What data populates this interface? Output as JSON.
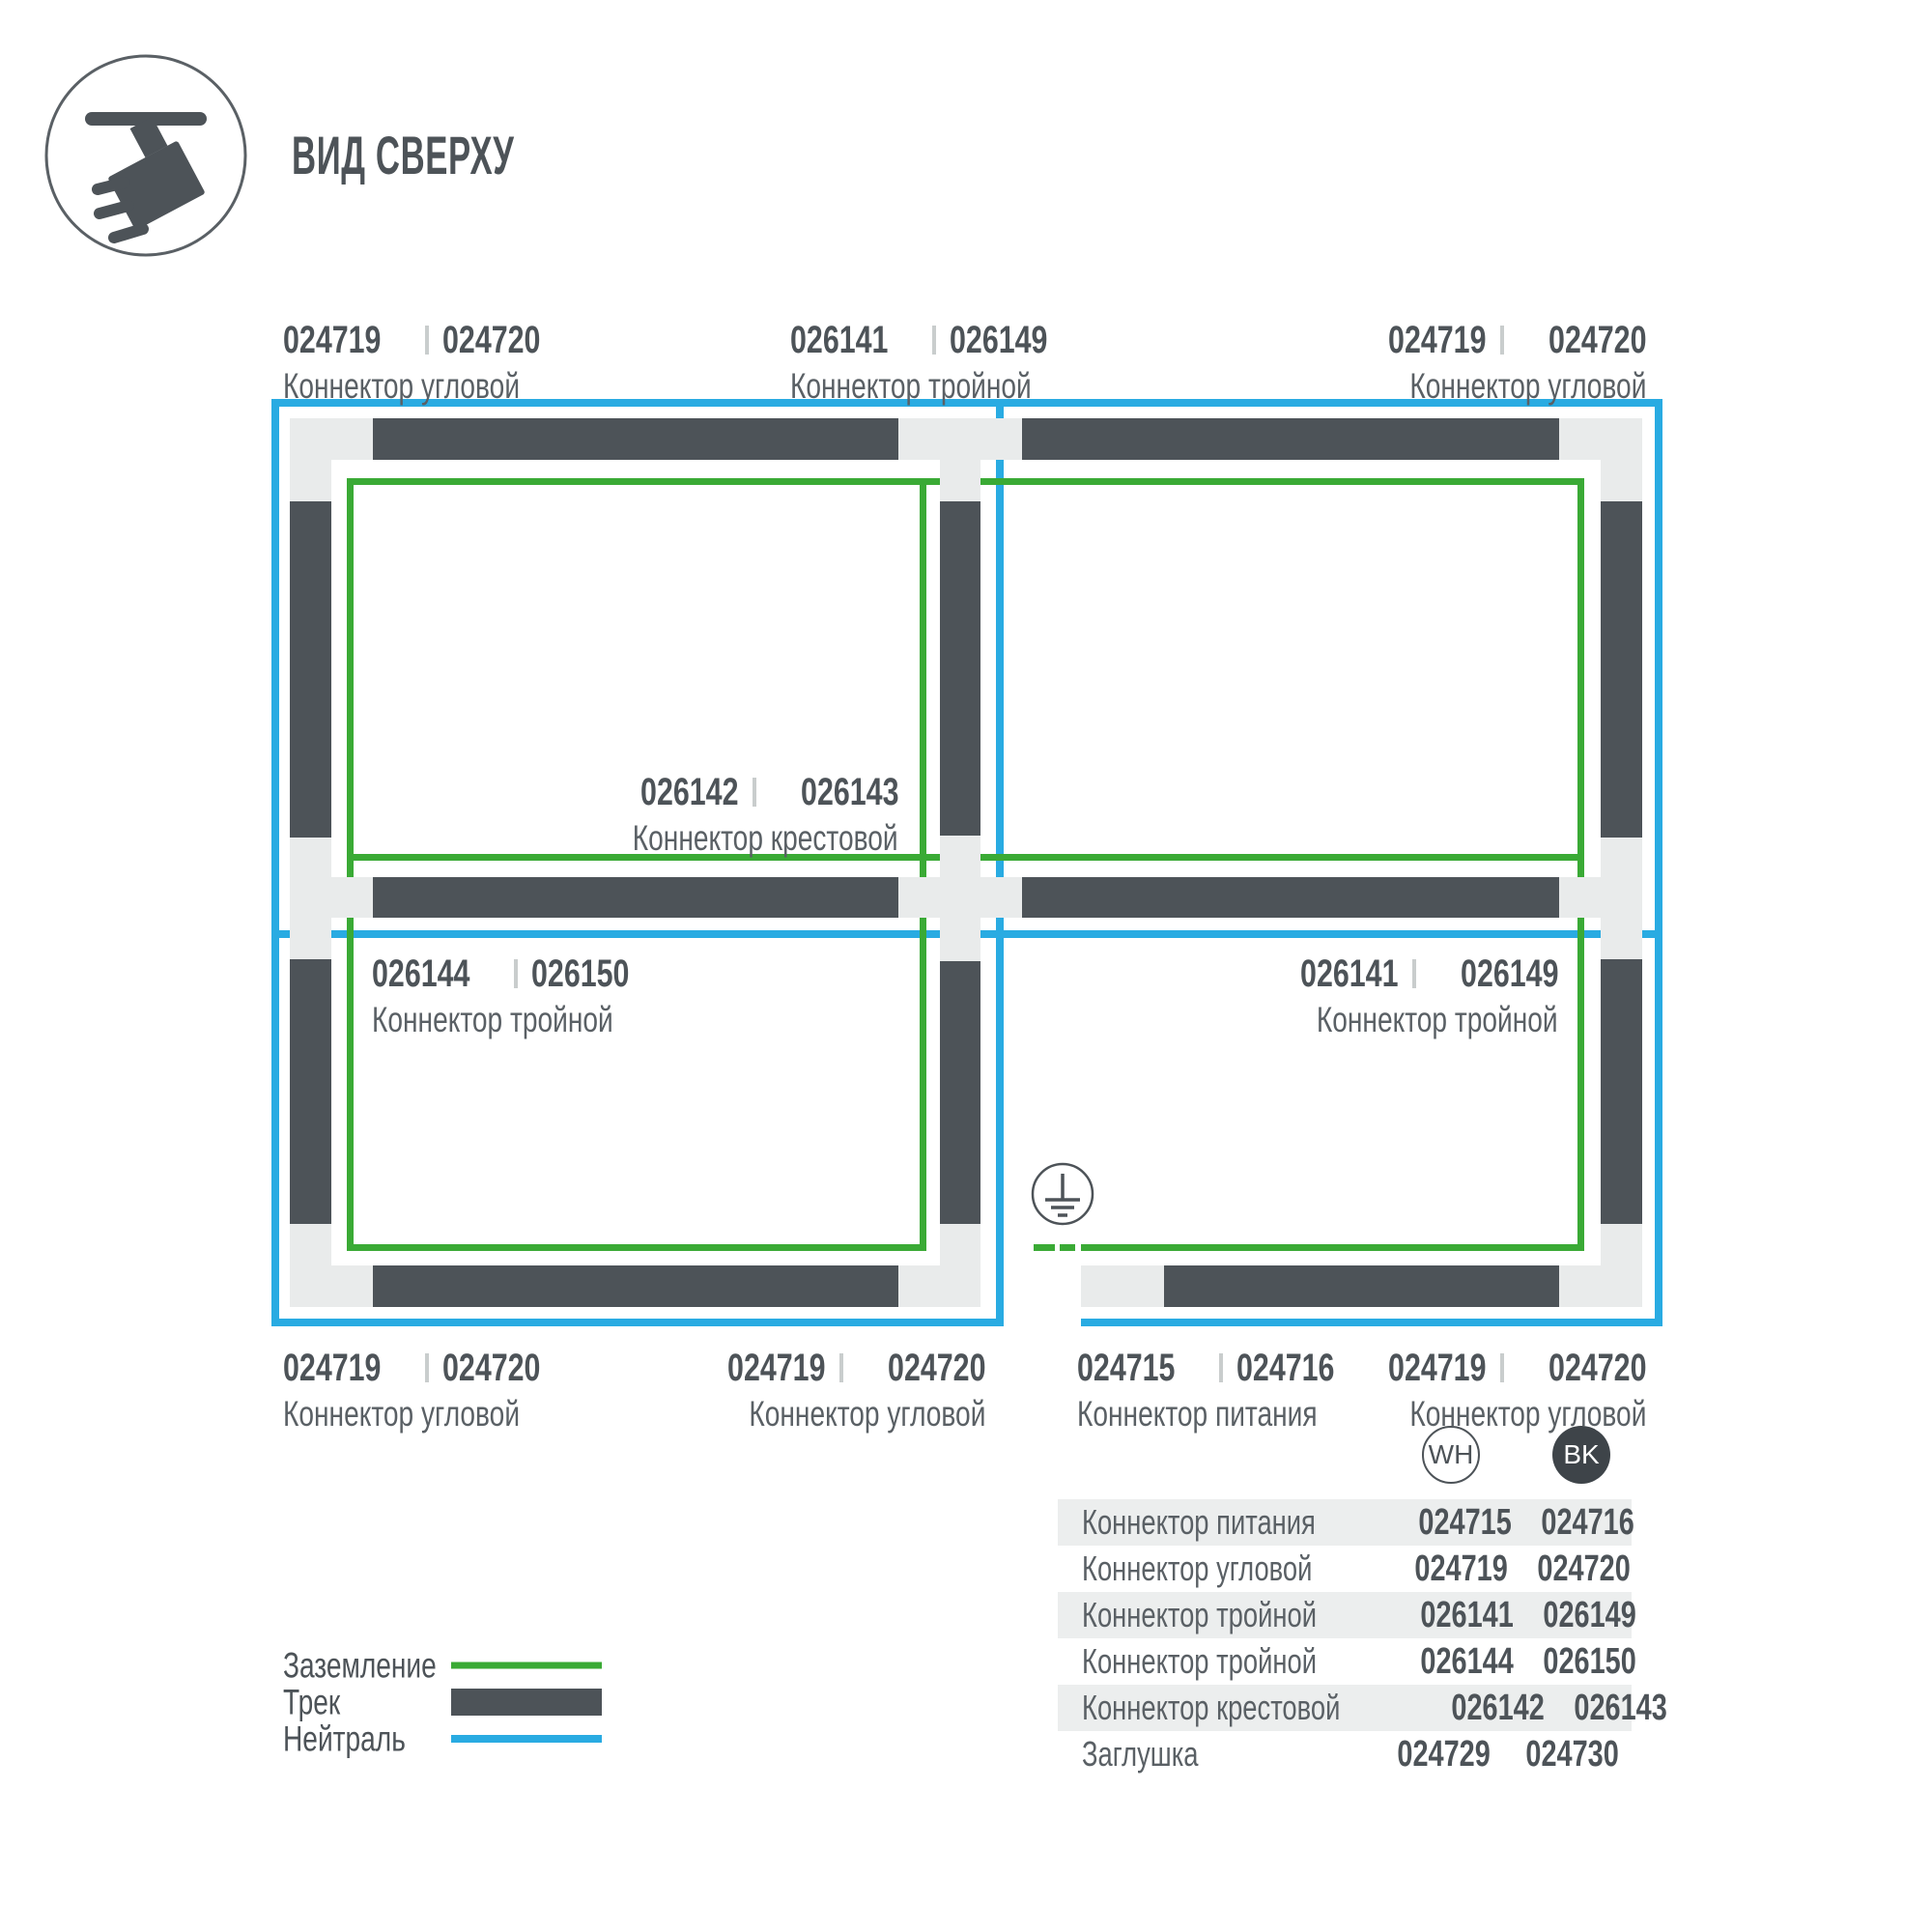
{
  "header": {
    "title": "ВИД СВЕРХУ",
    "icon": "track-spotlight-icon"
  },
  "diagram": {
    "labels": [
      {
        "position": "top-left",
        "wh": "024719",
        "bk": "024720",
        "name": "Коннектор угловой"
      },
      {
        "position": "top-middle",
        "wh": "026141",
        "bk": "026149",
        "name": "Коннектор тройной"
      },
      {
        "position": "top-right",
        "wh": "024719",
        "bk": "024720",
        "name": "Коннектор угловой"
      },
      {
        "position": "center",
        "wh": "026142",
        "bk": "026143",
        "name": "Коннектор крестовой"
      },
      {
        "position": "mid-left",
        "wh": "026144",
        "bk": "026150",
        "name": "Коннектор тройной"
      },
      {
        "position": "mid-right",
        "wh": "026141",
        "bk": "026149",
        "name": "Коннектор тройной"
      },
      {
        "position": "bottom-left",
        "wh": "024719",
        "bk": "024720",
        "name": "Коннектор угловой"
      },
      {
        "position": "bottom-middle",
        "wh": "024719",
        "bk": "024720",
        "name": "Коннектор угловой"
      },
      {
        "position": "bottom-power",
        "wh": "024715",
        "bk": "024716",
        "name": "Коннектор питания"
      },
      {
        "position": "bottom-right",
        "wh": "024719",
        "bk": "024720",
        "name": "Коннектор угловой"
      }
    ],
    "ground_symbol": "earth-ground",
    "colors": {
      "ground_green": "#3aaa35",
      "neutral_blue": "#29abe2",
      "track_dark": "#4d5358",
      "connector_light": "#e9ebeb"
    }
  },
  "legend": {
    "items": [
      {
        "label": "Заземление",
        "swatch": "ground-line"
      },
      {
        "label": "Трек",
        "swatch": "track-bar"
      },
      {
        "label": "Нейтраль",
        "swatch": "neutral-line"
      }
    ]
  },
  "table": {
    "columns": [
      {
        "code": "WH",
        "color": "#ffffff"
      },
      {
        "code": "BK",
        "color": "#3e4449"
      }
    ],
    "rows": [
      {
        "label": "Коннектор питания",
        "wh": "024715",
        "bk": "024716"
      },
      {
        "label": "Коннектор угловой",
        "wh": "024719",
        "bk": "024720"
      },
      {
        "label": "Коннектор тройной",
        "wh": "026141",
        "bk": "026149"
      },
      {
        "label": "Коннектор тройной",
        "wh": "026144",
        "bk": "026150"
      },
      {
        "label": "Коннектор крестовой",
        "wh": "026142",
        "bk": "026143"
      },
      {
        "label": "Заглушка",
        "wh": "024729",
        "bk": "024730"
      }
    ]
  }
}
